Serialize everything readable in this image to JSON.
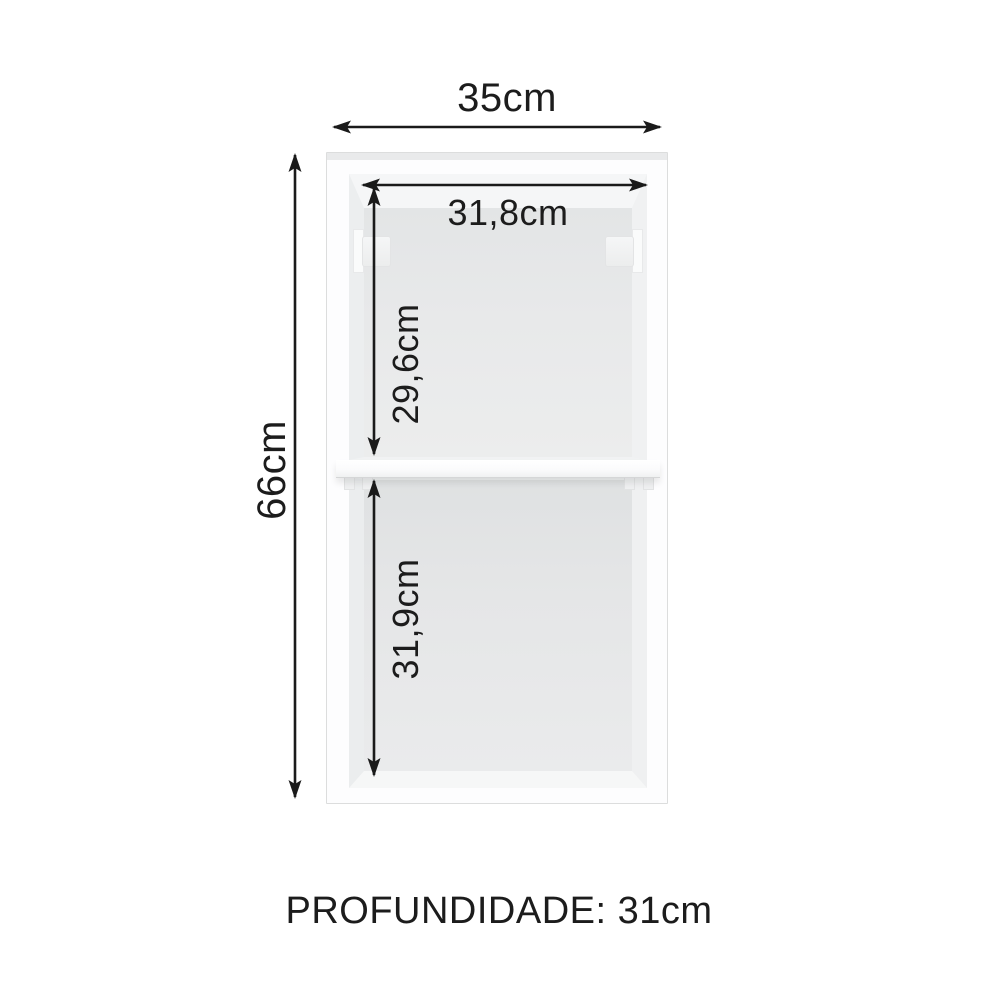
{
  "cabinet": {
    "width_label": "35cm",
    "height_label": "66cm",
    "inner_width_label": "31,8cm",
    "upper_compartment_height_label": "29,6cm",
    "lower_compartment_height_label": "31,9cm",
    "depth_label": "PROFUNDIDADE: 31cm"
  },
  "colors": {
    "bg": "#ffffff",
    "line": "#1a1a1a",
    "text": "#1c1c1c",
    "frame": "#fdfdfe",
    "frame-border": "#dcdddd",
    "interior-back": "#e8e9ea",
    "shelf": "#fbfbfc"
  }
}
